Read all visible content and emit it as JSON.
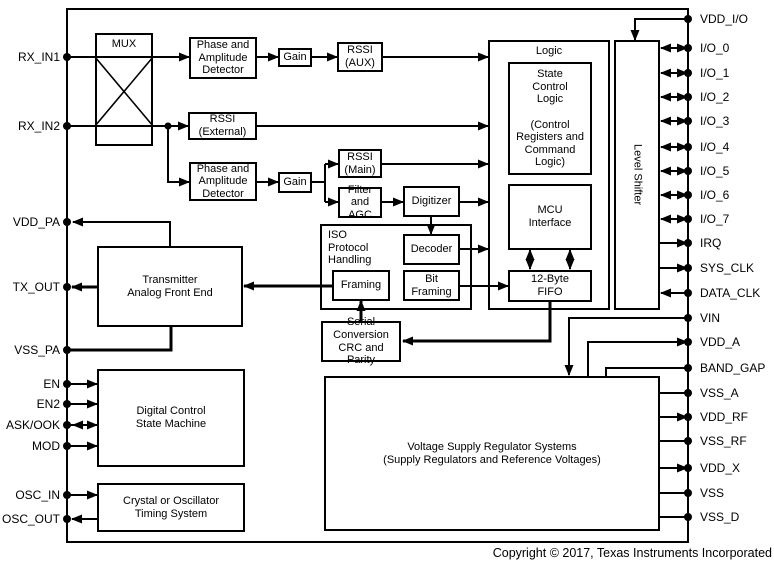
{
  "pins": {
    "left": [
      "RX_IN1",
      "RX_IN2",
      "VDD_PA",
      "TX_OUT",
      "VSS_PA",
      "EN",
      "EN2",
      "ASK/OOK",
      "MOD",
      "OSC_IN",
      "OSC_OUT"
    ],
    "right": [
      "VDD_I/O",
      "I/O_0",
      "I/O_1",
      "I/O_2",
      "I/O_3",
      "I/O_4",
      "I/O_5",
      "I/O_6",
      "I/O_7",
      "IRQ",
      "SYS_CLK",
      "DATA_CLK",
      "VIN",
      "VDD_A",
      "BAND_GAP",
      "VSS_A",
      "VDD_RF",
      "VSS_RF",
      "VDD_X",
      "VSS",
      "VSS_D"
    ]
  },
  "blocks": {
    "mux": "MUX",
    "phase_amp_1": "Phase and\nAmplitude\nDetector",
    "gain_1": "Gain",
    "rssi_aux": "RSSI\n(AUX)",
    "rssi_external": "RSSI\n(External)",
    "phase_amp_2": "Phase and\nAmplitude\nDetector",
    "gain_2": "Gain",
    "rssi_main": "RSSI\n(Main)",
    "filter_agc": "Filter\nand AGC",
    "digitizer": "Digitizer",
    "iso_protocol": "ISO\nProtocol\nHandling",
    "decoder": "Decoder",
    "bit_framing": "Bit\nFraming",
    "framing": "Framing",
    "serial_conversion": "Serial\nConversion\nCRC and Parity",
    "logic": "Logic",
    "state_control_logic": "State\nControl\nLogic\n\n(Control\nRegisters and\nCommand\nLogic)",
    "mcu_interface": "MCU\nInterface",
    "fifo": "12-Byte\nFIFO",
    "level_shifter": "Level Shifter",
    "transmitter": "Transmitter\nAnalog Front End",
    "digital_control": "Digital Control\nState Machine",
    "crystal": "Crystal or Oscillator\nTiming System",
    "regulator": "Voltage Supply Regulator Systems\n(Supply Regulators and Reference Voltages)"
  },
  "footer": {
    "copyright": "Copyright © 2017, Texas Instruments Incorporated"
  },
  "colors": {
    "line": "#000000",
    "background": "#ffffff"
  }
}
